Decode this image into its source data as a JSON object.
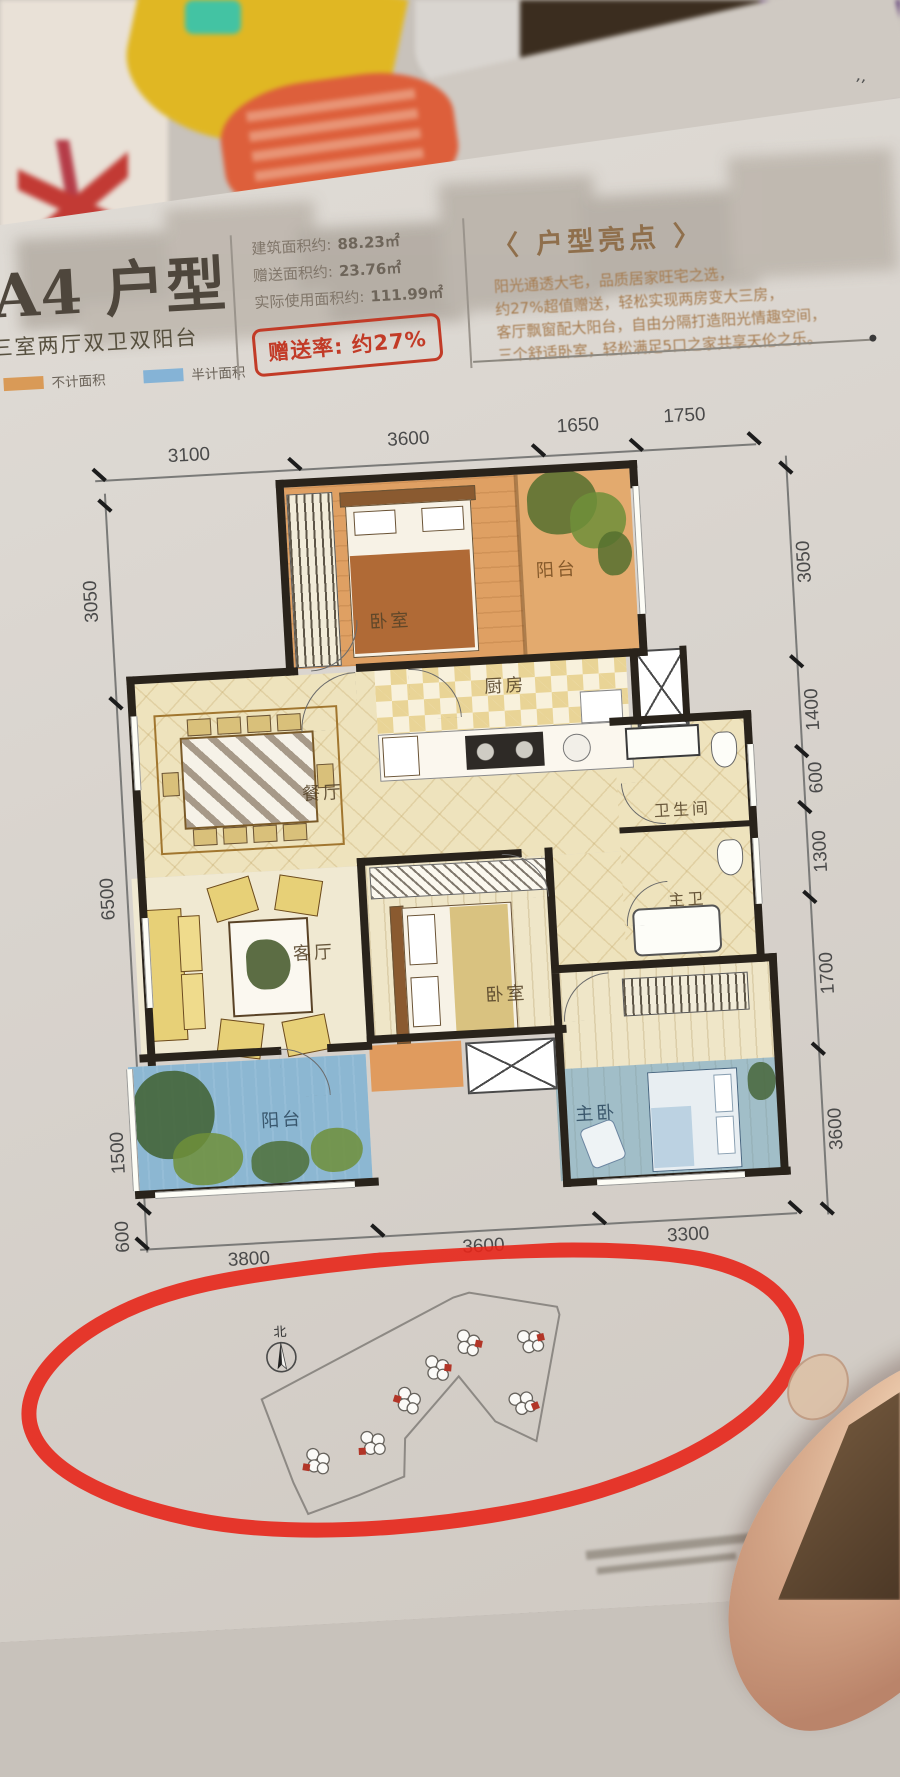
{
  "photo": {
    "corner_mark": "’’"
  },
  "header": {
    "title": "A4 户型",
    "subtitle": "三室两厅双卫双阳台",
    "legend": [
      {
        "label": "不计面积",
        "color": "#d99a57"
      },
      {
        "label": "半计面积",
        "color": "#85b3d6"
      }
    ],
    "areas": [
      {
        "label": "建筑面积约:",
        "value": "88.23㎡"
      },
      {
        "label": "赠送面积约:",
        "value": "23.76㎡"
      },
      {
        "label": "实际使用面积约:",
        "value": "111.99㎡"
      }
    ],
    "stamp": "赠送率: 约27%",
    "highlights_title": "〈 户型亮点 〉",
    "highlights": [
      "阳光通透大宅，品质居家旺宅之选，",
      "约27%超值赠送，轻松实现两房变大三房，",
      "客厅飘窗配大阳台，自由分隔打造阳光情趣空间，",
      "三个舒适卧室，轻松满足5口之家共享天伦之乐。"
    ]
  },
  "plan": {
    "dims_top": [
      "3100",
      "3600",
      "1650",
      "1750"
    ],
    "dims_left": [
      "3050",
      "6500",
      "1500",
      "600"
    ],
    "dims_right": [
      "3050",
      "1400",
      "600",
      "1300",
      "1700",
      "3600"
    ],
    "dims_bottom": [
      "3800",
      "3600",
      "3300"
    ],
    "rooms": {
      "bedroom_top": "卧室",
      "balcony_top": "阳台",
      "kitchen": "厨房",
      "dining": "餐厅",
      "bathroom": "卫生间",
      "master_bath": "主卫",
      "living": "客厅",
      "bedroom_mid": "卧室",
      "master_bedroom": "主卧",
      "balcony_bottom": "阳台"
    }
  },
  "siteplan": {
    "north": "北"
  },
  "colors": {
    "marker_red": "#e7261a",
    "orange_area": "#dfa062",
    "blue_area": "#7fb0d4",
    "stamp_red": "#c23b27"
  }
}
